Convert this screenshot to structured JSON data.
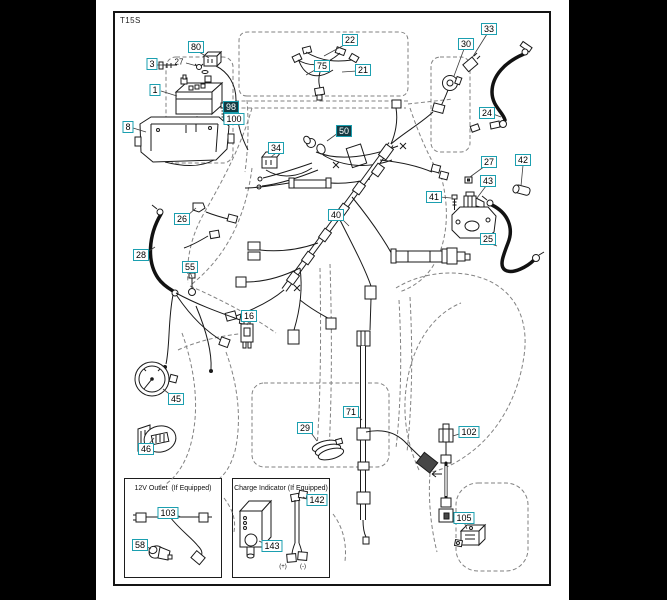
{
  "page": {
    "sheet_code": "T15S",
    "letterbox_color": "#000000",
    "paper_color": "#ffffff",
    "frame_border_color": "#141414"
  },
  "callout_style": {
    "border_color": "#1b9fb0",
    "fill_color": "#ffffff",
    "text_color": "#000000",
    "filled_fill_color": "#123a42",
    "filled_text_color": "#ffffff"
  },
  "callouts": [
    {
      "label": "80",
      "x": 196,
      "y": 47
    },
    {
      "label": "3",
      "x": 152,
      "y": 64
    },
    {
      "label": "1",
      "x": 155,
      "y": 90
    },
    {
      "label": "8",
      "x": 128,
      "y": 127
    },
    {
      "label": "98",
      "x": 231,
      "y": 107,
      "filled": true
    },
    {
      "label": "100",
      "x": 234,
      "y": 119
    },
    {
      "label": "22",
      "x": 350,
      "y": 40
    },
    {
      "label": "75",
      "x": 322,
      "y": 66
    },
    {
      "label": "21",
      "x": 363,
      "y": 70
    },
    {
      "label": "30",
      "x": 466,
      "y": 44
    },
    {
      "label": "33",
      "x": 489,
      "y": 29
    },
    {
      "label": "24",
      "x": 487,
      "y": 113
    },
    {
      "label": "34",
      "x": 276,
      "y": 148
    },
    {
      "label": "50",
      "x": 344,
      "y": 131,
      "filled": true
    },
    {
      "label": "27",
      "x": 489,
      "y": 162
    },
    {
      "label": "42",
      "x": 523,
      "y": 160
    },
    {
      "label": "43",
      "x": 488,
      "y": 181
    },
    {
      "label": "41",
      "x": 434,
      "y": 197
    },
    {
      "label": "25",
      "x": 488,
      "y": 239
    },
    {
      "label": "26",
      "x": 182,
      "y": 219
    },
    {
      "label": "28",
      "x": 141,
      "y": 255
    },
    {
      "label": "55",
      "x": 190,
      "y": 267
    },
    {
      "label": "40",
      "x": 336,
      "y": 215
    },
    {
      "label": "16",
      "x": 249,
      "y": 316
    },
    {
      "label": "45",
      "x": 176,
      "y": 399
    },
    {
      "label": "46",
      "x": 146,
      "y": 449
    },
    {
      "label": "29",
      "x": 305,
      "y": 428
    },
    {
      "label": "71",
      "x": 351,
      "y": 412
    },
    {
      "label": "102",
      "x": 469,
      "y": 432
    },
    {
      "label": "105",
      "x": 464,
      "y": 518
    },
    {
      "label": "103",
      "x": 168,
      "y": 513
    },
    {
      "label": "58",
      "x": 140,
      "y": 545
    },
    {
      "label": "142",
      "x": 317,
      "y": 500
    },
    {
      "label": "143",
      "x": 272,
      "y": 546
    }
  ],
  "plain_labels": [
    {
      "label": "27",
      "x": 179,
      "y": 62
    },
    {
      "label": "(+)",
      "x": 283,
      "y": 567,
      "small": true
    },
    {
      "label": "(-)",
      "x": 303,
      "y": 567,
      "small": true
    }
  ],
  "insets": {
    "outlet_box": {
      "title": "12V Outlet  (If Equipped)"
    },
    "charge_box": {
      "title": "Charge Indicator (If Equipped)"
    }
  }
}
